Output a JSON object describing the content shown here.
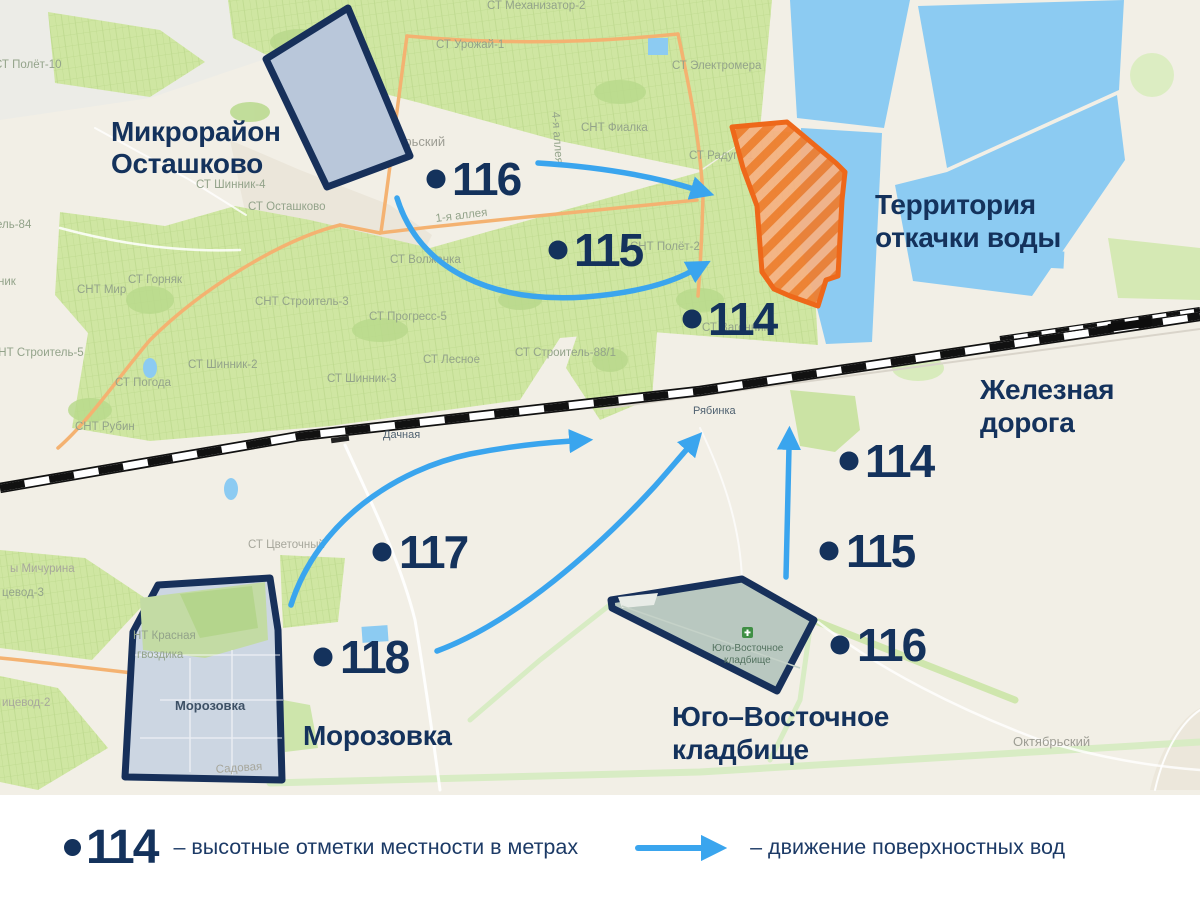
{
  "annotations": {
    "microdistrict_line1": "Микрорайон",
    "microdistrict_line2": "Осташково",
    "pumping_line1": "Территория",
    "pumping_line2": "откачки воды",
    "railroad_line1": "Железная",
    "railroad_line2": "дорога",
    "morozovka": "Морозовка",
    "cemetery_line1": "Юго–Восточное",
    "cemetery_line2": "кладбище"
  },
  "markers": [
    {
      "value": "116"
    },
    {
      "value": "115"
    },
    {
      "value": "114"
    },
    {
      "value": "114"
    },
    {
      "value": "115"
    },
    {
      "value": "116"
    },
    {
      "value": "117"
    },
    {
      "value": "118"
    }
  ],
  "map_labels": {
    "mekhanizator": "СТ Механизатор-2",
    "urozhay": "СТ Урожай-1",
    "elektromera": "СТ Электромера",
    "fialka": "СНТ Фиалка",
    "alleya4": "4-я аллея",
    "raduga": "СТ Радуга-1",
    "alleya1": "1-я аллея",
    "volzhanka": "СТ Волжанка",
    "polet2": "СНТ Полёт-2",
    "oktyabrsky_top": "Октябрьский",
    "ostashkovo_st": "СТ Осташково",
    "shinnik4": "СТ Шинник-4",
    "polet10": "СТ Полёт-10",
    "el84": "ель-84",
    "nik": "ник",
    "mir": "СНТ Мир",
    "gornyak": "СТ Горняк",
    "stroitel3": "СНТ Строитель-3",
    "stroitel5": "СНТ Строитель-5",
    "pogoda": "СТ Погода",
    "shinnik2": "СТ Шинник-2",
    "rubin": "СНТ Рубин",
    "progress5": "СТ Прогресс-5",
    "shinnik3": "СТ Шинник-3",
    "lesnoye": "СТ Лесное",
    "stroitel88": "СТ Строитель-88/1",
    "dachnaya": "Дачная",
    "ryabinka": "Рябинка",
    "vagonnik": "СТ Вагонник",
    "michurina": "ы Мичурина",
    "tsvetochny": "СТ Цветочный",
    "ptitsevod3": "цевод-3",
    "ptitsevod2": "ицевод-2",
    "krasnaya1": "НТ Красная",
    "krasnaya2": "гвоздика",
    "morozovka_map": "Морозовка",
    "sadovaya": "Садовая",
    "cemetery_map1": "Юго-Восточное",
    "cemetery_map2": "кладбище",
    "oktyabrsky_bottom": "Октябрьский"
  },
  "legend": {
    "elevation_value": "114",
    "elevation_label": "–  высотные отметки местности в метрах",
    "flow_label": "–  движение поверхностных вод"
  },
  "colors": {
    "navy": "#14325c",
    "arrow_blue": "#3aa5ee",
    "pump_orange": "#ee681a",
    "water_blue": "#8ccbf2",
    "green": "#cfe6a2"
  }
}
